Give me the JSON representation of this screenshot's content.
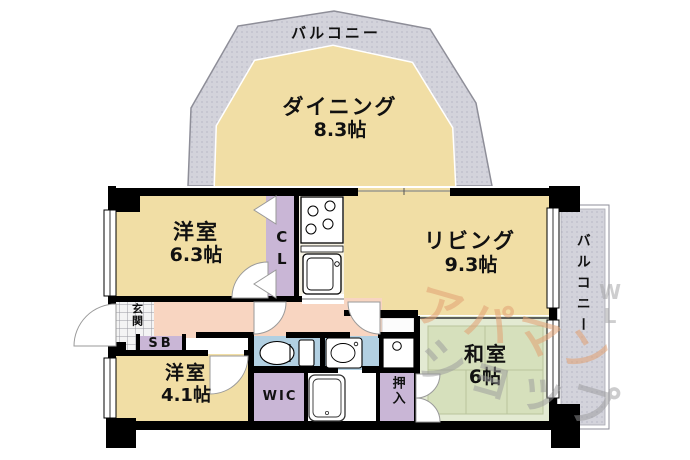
{
  "floorplan": {
    "balcony_top": {
      "label": "バルコニー"
    },
    "balcony_right": {
      "label": "バルコニー"
    },
    "rooms": {
      "dining": {
        "name": "ダイニング",
        "size": "8.3帖"
      },
      "living": {
        "name": "リビング",
        "size": "9.3帖"
      },
      "western1": {
        "name": "洋室",
        "size": "6.3帖"
      },
      "western2": {
        "name": "洋室",
        "size": "4.1帖"
      },
      "japanese": {
        "name": "和室",
        "size": "6帖"
      },
      "entrance": {
        "label": "玄関"
      },
      "closet": {
        "label": "CL"
      },
      "shoe_box": {
        "label": "SB"
      },
      "wic": {
        "label": "WIC"
      },
      "oshiire": {
        "label": "押入"
      }
    },
    "watermark": {
      "part1": "アパマン",
      "part2": "ショップ",
      "part3": "WL"
    },
    "colors": {
      "room_tan": "#F1DEA5",
      "hallway_pink": "#F8D5C1",
      "tatami_green": "#D6E0BC",
      "closet_lavender": "#C9B6D6",
      "sanitary_blue": "#B2D0E2",
      "balcony_grey": "#D3D3DB",
      "wall_black": "#000000"
    }
  }
}
